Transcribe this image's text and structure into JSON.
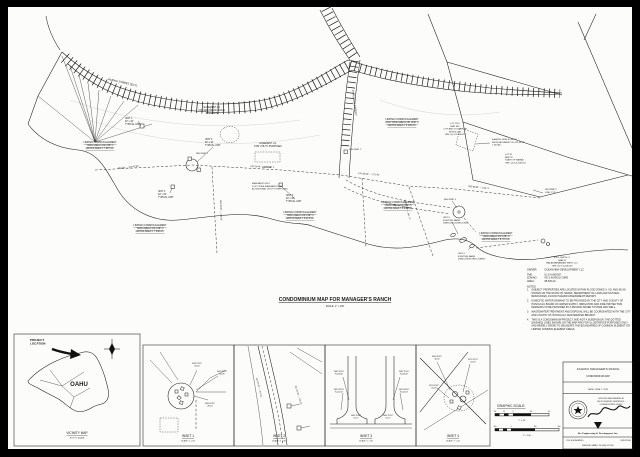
{
  "title": {
    "text": "CONDOMINIUM MAP FOR MANAGER'S RANCH",
    "scale": "SCALE: 1\" = 100'"
  },
  "notes": {
    "owner_label": "OWNER:",
    "owner": "OCEANVIEW DEVELOPMENT LLC",
    "info": [
      {
        "k": "TMK:",
        "v": "(1) 5-6-008:007"
      },
      {
        "k": "ZONING:",
        "v": "AG-2 AGRICULTURE"
      },
      {
        "k": "AREA:",
        "v": "98.636 AC."
      }
    ],
    "heading": "NOTES:",
    "items": [
      "SUBJECT PROPERTIES ARE LOCATED WITHIN FLOOD ZONES X, XS, AND AE AS SHOWN ON THE STATE OF HAWAII, DEPARTMENT OF LAND AND NATURAL RESOURCES, FLOOD HAZARD ASSESSMENT REPORT.",
      "DOMESTIC WATER DEMAND TO BE PROVIDED BY THE CITY AND COUNTY OF HONOLULU BOARD OF WATER SUPPLY. IRRIGATION AND FIRE PROTECTION DEMANDS TO BE PROVIDED BY A PRIVATE WATER SYSTEM AND WELL.",
      "WASTEWATER TREATMENT AND DISPOSAL WILL BE COORDINATED WITH THE CITY AND COUNTY OF HONOLULU WASTEWATER BRANCH.",
      "THIS IS A CONDOMINIUM PROJECT, AND NOT A SUBDIVISION. THE DOTTED (DASHED) LINES SHOWN ON THE MAP ARE FOR ILLUSTRATIVE PURPOSES ONLY AND MERELY SERVE TO DELINEATE THE BOUNDARIES OF COMMON ELEMENT OR LIMITED COMMON ELEMENT AREAS."
    ]
  },
  "map": {
    "labels": [
      {
        "x": 335,
        "y": 301,
        "t": "CONDOMINIUM MAP FOR MANAGER'S RANCH",
        "s": 5,
        "b": 1,
        "u": 1,
        "a": "middle",
        "n": "map-title"
      },
      {
        "x": 335,
        "y": 307,
        "t": "SCALE: 1\" = 100'",
        "s": 2.4,
        "a": "middle",
        "n": "map-scale"
      },
      {
        "x": 108,
        "y": 80,
        "rot": 13,
        "t": "HUEHU STREET (EXT)",
        "s": 2.8,
        "n": "street-label-huehu"
      },
      {
        "x": 352,
        "y": 90,
        "rot": 83,
        "t": "PUALALEA STREET",
        "s": 2.8,
        "n": "street-label-pualalea"
      },
      {
        "x": 212,
        "y": 108,
        "a": "middle",
        "t": "EASEMENT A-1\nFOR ARCHAEOLOGICAL\nPRESERVE",
        "s": 2.3,
        "n": "easement-a1-label"
      },
      {
        "x": 268,
        "y": 144,
        "a": "middle",
        "t": "EASEMENT U-1\nFOR UTILITY PURPOSES",
        "s": 2.3,
        "n": "easement-u1-label"
      },
      {
        "x": 252,
        "y": 184,
        "t": "EASEMENT DW-1\n16 FT. WIDE EASEMENT FOR\nACCESS AND UTILITY PURPOSES",
        "s": 2.2,
        "n": "easement-dw1-label"
      },
      {
        "x": 100,
        "y": 143,
        "a": "middle",
        "u": 1,
        "t": "LIMITED COMMON ELEMENT\nYARD AREA FOR UNIT 1\nGROSS AREA = 7.687 AC.",
        "s": 2.4,
        "n": "lce-unit1"
      },
      {
        "x": 150,
        "y": 226,
        "a": "middle",
        "u": 1,
        "t": "LIMITED COMMON ELEMENT\nYARD AREA FOR UNIT 2\nGROSS AREA = 7.946 AC.",
        "s": 2.4,
        "n": "lce-unit2"
      },
      {
        "x": 300,
        "y": 213,
        "a": "middle",
        "u": 1,
        "t": "LIMITED COMMON ELEMENT\nYARD AREA FOR UNIT 3\nGROSS AREA = 8.113 AC.",
        "s": 2.4,
        "n": "lce-unit3"
      },
      {
        "x": 402,
        "y": 120,
        "a": "middle",
        "u": 1,
        "t": "LIMITED COMMON ELEMENT\nAND YARD AREA FOR UNIT 4\nGROSS AREA = 5.228 AC.",
        "s": 2.4,
        "n": "lce-unit4"
      },
      {
        "x": 398,
        "y": 203,
        "a": "middle",
        "u": 1,
        "t": "LIMITED COMMON ELEMENT\nYARD AREA FOR UNIT 5\nGROSS AREA = 6.034 AC.",
        "s": 2.4,
        "n": "lce-unit5"
      },
      {
        "x": 496,
        "y": 234,
        "a": "middle",
        "u": 1,
        "t": "LIMITED COMMON ELEMENT\nYARD AREA FOR UNIT 6\nGROSS AREA = 8.767 AC.",
        "s": 2.4,
        "n": "lce-unit6"
      },
      {
        "x": 125,
        "y": 119,
        "t": "UNIT 1\n40' x 40'\nTYPICAL UNIT",
        "s": 2.3,
        "n": "unit1-callout"
      },
      {
        "x": 205,
        "y": 140,
        "t": "UNIT 2\n40' x 40'\nTYPICAL UNIT",
        "s": 2.3,
        "n": "unit2-callout"
      },
      {
        "x": 158,
        "y": 192,
        "t": "UNIT 3\n40' x 40'\nTYPICAL UNIT",
        "s": 2.3,
        "n": "unit3-callout"
      },
      {
        "x": 286,
        "y": 196,
        "t": "UNIT 4\n40' x 40'\nTYPICAL UNIT",
        "s": 2.3,
        "n": "unit4-callout"
      },
      {
        "x": 443,
        "y": 218,
        "t": "UNIT 5\nEXISTING FARM\nDWELLING (DWELLING)",
        "s": 2.2,
        "n": "unit5-callout"
      },
      {
        "x": 458,
        "y": 254,
        "t": "UNIT 6\nEXISTING FARM\nDWELLING/STRUCTURES",
        "s": 2.2,
        "n": "unit6-callout"
      },
      {
        "x": 455,
        "y": 124,
        "a": "middle",
        "t": "LOT 1110\nBMP 632\nCITY AND COUNTY OF\nHONOLULU\nTMK: (1) 5-6-008:020",
        "s": 2.2,
        "n": "lot-1110-label"
      },
      {
        "x": 492,
        "y": 140,
        "t": "KAHUKU HIGH SCHOOL\nENCROACHMENT 42,128.44 SF\n1.434 AC.",
        "s": 2.2,
        "n": "school-encroachment-label"
      },
      {
        "x": 505,
        "y": 155,
        "t": "LOT 47\nBMP 32\nSTATE OF HAWAII\nTMK: (1) 5-6-008:001",
        "s": 2.2,
        "n": "lot-47-label"
      },
      {
        "x": 562,
        "y": 258,
        "a": "middle",
        "t": "EXCLUSION #1\n(MAP 2)\nMALAEKAHANA AG WEST LLC\nTMK: (1) 5-6-008:033",
        "s": 2.2,
        "n": "exclusion-label"
      },
      {
        "x": 545,
        "y": 190,
        "t": "PROPERTY\nLINE, TYP.",
        "s": 2.2,
        "n": "property-line-label"
      },
      {
        "x": 118,
        "y": 169,
        "rot": -6,
        "t": "762.08' — S72°47'30\"",
        "s": 2.2,
        "n": "bearing-label"
      },
      {
        "x": 250,
        "y": 167,
        "rot": 2,
        "t": "S78°26'40\" — 970.49'",
        "s": 2.2,
        "n": "bearing-label"
      },
      {
        "x": 358,
        "y": 174,
        "rot": 4,
        "t": "S79°58'20\" — 271.46'",
        "s": 2.2,
        "n": "bearing-label"
      },
      {
        "x": 468,
        "y": 187,
        "rot": 6,
        "t": "S82°05'30\" — 246.71'",
        "s": 2.2,
        "n": "bearing-label"
      },
      {
        "x": 404,
        "y": 200,
        "rot": 75,
        "t": "N06°15'40\" — 307.73'",
        "s": 2.1,
        "n": "bearing-label"
      },
      {
        "x": 220,
        "y": 200,
        "rot": 88,
        "t": "N03°39'20\" — 165.08'",
        "s": 2.1,
        "n": "bearing-label"
      },
      {
        "x": 196,
        "y": 154,
        "t": "SEE INSET 1",
        "s": 2,
        "n": "see-inset-1"
      },
      {
        "x": 349,
        "y": 150,
        "t": "SEE INSET 2",
        "s": 2,
        "n": "see-inset-2"
      },
      {
        "x": 262,
        "y": 168,
        "t": "SEE INSET 3",
        "s": 2,
        "n": "see-inset-3"
      },
      {
        "x": 444,
        "y": 200,
        "t": "SEE INSET 4",
        "s": 2,
        "n": "see-inset-4"
      },
      {
        "x": 30,
        "y": 341,
        "t": "PROJECT\nLOCATION",
        "s": 3,
        "b": 1,
        "n": "project-location-label"
      },
      {
        "x": 79,
        "y": 386,
        "t": "OAHU",
        "s": 6,
        "b": 1,
        "a": "middle",
        "n": "island-label"
      },
      {
        "x": 77,
        "y": 434,
        "t": "VICINITY MAP",
        "s": 3.2,
        "u": 1,
        "a": "middle",
        "n": "vicinity-caption"
      },
      {
        "x": 77,
        "y": 438.6,
        "t": "NOT TO SCALE",
        "s": 2,
        "a": "middle",
        "n": "vicinity-subcaption"
      },
      {
        "x": 188,
        "y": 437,
        "t": "INSET 1",
        "s": 3.2,
        "u": 1,
        "a": "middle",
        "n": "inset-1-caption"
      },
      {
        "x": 188,
        "y": 441.6,
        "t": "SCALE: 1\" = 30'",
        "s": 1.9,
        "a": "middle",
        "n": "inset-1-scale"
      },
      {
        "x": 279,
        "y": 437,
        "t": "INSET 2",
        "s": 3.2,
        "u": 1,
        "a": "middle",
        "n": "inset-2-caption"
      },
      {
        "x": 279,
        "y": 441.6,
        "t": "SCALE: 1\" = 30'",
        "s": 1.9,
        "a": "middle",
        "n": "inset-2-scale"
      },
      {
        "x": 366,
        "y": 437,
        "t": "INSET 3",
        "s": 3.2,
        "u": 1,
        "a": "middle",
        "n": "inset-3-caption"
      },
      {
        "x": 366,
        "y": 441.6,
        "t": "SCALE: 1\" = 30'",
        "s": 1.9,
        "a": "middle",
        "n": "inset-3-scale"
      },
      {
        "x": 453,
        "y": 437,
        "t": "INSET 4",
        "s": 3.2,
        "u": 1,
        "a": "middle",
        "n": "inset-4-caption"
      },
      {
        "x": 453,
        "y": 441.6,
        "t": "SCALE: 1\" = 30'",
        "s": 1.9,
        "a": "middle",
        "n": "inset-4-scale"
      },
      {
        "x": 197,
        "y": 364,
        "a": "middle",
        "t": "S08°15'30\"\n30.00'",
        "s": 2,
        "n": "inset1-bearing"
      },
      {
        "x": 222,
        "y": 372,
        "a": "middle",
        "t": "N41°23'10\"\n56.08'",
        "s": 2,
        "n": "inset1-bearing"
      },
      {
        "x": 210,
        "y": 404,
        "a": "middle",
        "t": "N83°02'40\"\n28.00'",
        "s": 2,
        "n": "inset1-bearing"
      },
      {
        "x": 256,
        "y": 378,
        "rot": 76,
        "t": "N10°28'30\" — 262.40'",
        "s": 2,
        "n": "inset2-bearing"
      },
      {
        "x": 295,
        "y": 386,
        "rot": 73,
        "t": "N12°46'10\" — 154.22'",
        "s": 2,
        "n": "inset2-bearing"
      },
      {
        "x": 339,
        "y": 372,
        "a": "middle",
        "t": "N08°15'30\"\nR=28.00'",
        "s": 2,
        "n": "inset3-bearing"
      },
      {
        "x": 339,
        "y": 390,
        "a": "middle",
        "t": "N81°44'30\"\nR=20.00'",
        "s": 2,
        "n": "inset3-bearing"
      },
      {
        "x": 404,
        "y": 372,
        "a": "middle",
        "t": "N08°15'30\"\nR=28.00'",
        "s": 2,
        "n": "inset3-bearing"
      },
      {
        "x": 404,
        "y": 390,
        "a": "middle",
        "t": "N81°44'30\"\nR=20.00'",
        "s": 2,
        "n": "inset3-bearing"
      },
      {
        "x": 356,
        "y": 416,
        "a": "middle",
        "t": "N08°15'30\"\n16.17'",
        "s": 2,
        "n": "inset3-bearing"
      },
      {
        "x": 388,
        "y": 416,
        "a": "middle",
        "t": "N08°15'30\"\n16.17'",
        "s": 2,
        "n": "inset3-bearing"
      },
      {
        "x": 437,
        "y": 357,
        "a": "middle",
        "t": "S68°30'50\"\n30.00'",
        "s": 2,
        "n": "inset4-bearing"
      },
      {
        "x": 473,
        "y": 360,
        "a": "middle",
        "t": "N21°29'10\"\n24.00'",
        "s": 2,
        "n": "inset4-bearing"
      },
      {
        "x": 434,
        "y": 386,
        "a": "middle",
        "t": "S81°02'40\"\n18.00'",
        "s": 2,
        "n": "inset4-bearing"
      },
      {
        "x": 497,
        "y": 407,
        "t": "GRAPHIC SCALE:",
        "s": 3.4,
        "u": 1,
        "n": "graphic-scale-heading"
      },
      {
        "x": 495,
        "y": 412,
        "a": "middle",
        "t": "30",
        "s": 1.7,
        "n": "scalebar-tick"
      },
      {
        "x": 504,
        "y": 412,
        "a": "middle",
        "t": "15",
        "s": 1.7,
        "n": "scalebar-tick"
      },
      {
        "x": 513,
        "y": 412,
        "a": "middle",
        "t": "0",
        "s": 1.7,
        "n": "scalebar-tick"
      },
      {
        "x": 531,
        "y": 412,
        "a": "middle",
        "t": "30",
        "s": 1.7,
        "n": "scalebar-tick"
      },
      {
        "x": 549,
        "y": 412,
        "a": "middle",
        "t": "60",
        "s": 1.7,
        "n": "scalebar-tick"
      },
      {
        "x": 522,
        "y": 421,
        "a": "middle",
        "t": "1\" = 30'",
        "s": 2.2,
        "n": "scalebar-caption"
      },
      {
        "x": 495,
        "y": 427,
        "a": "middle",
        "t": "100",
        "s": 1.7,
        "n": "scalebar-tick"
      },
      {
        "x": 511,
        "y": 427,
        "a": "middle",
        "t": "0",
        "s": 1.7,
        "n": "scalebar-tick"
      },
      {
        "x": 535,
        "y": 427,
        "a": "middle",
        "t": "100",
        "s": 1.7,
        "n": "scalebar-tick"
      },
      {
        "x": 559,
        "y": 427,
        "a": "middle",
        "t": "200",
        "s": 1.7,
        "n": "scalebar-tick"
      },
      {
        "x": 527,
        "y": 436,
        "a": "middle",
        "t": "1\" = 100'",
        "s": 2.2,
        "n": "scalebar-caption"
      },
      {
        "x": 598,
        "y": 370,
        "a": "middle",
        "t": "KAHUKU MANAGER'S RANCH",
        "s": 3,
        "n": "titleblock-project"
      },
      {
        "x": 598,
        "y": 377,
        "a": "middle",
        "t": "CONDOMINIUM MAP",
        "s": 2.4,
        "n": "titleblock-subtitle"
      },
      {
        "x": 598,
        "y": 390,
        "a": "middle",
        "t": "DATE: JUNE 7, 2021",
        "s": 2.2,
        "n": "titleblock-date"
      },
      {
        "x": 611,
        "y": 399,
        "a": "middle",
        "t": "THIS WORK WAS PREPARED BY",
        "s": 1.7,
        "n": "stamp-text"
      },
      {
        "x": 611,
        "y": 402,
        "a": "middle",
        "t": "ME OR UNDER MY SUPERVISION.",
        "s": 1.7,
        "n": "stamp-text"
      },
      {
        "x": 611,
        "y": 405,
        "a": "middle",
        "t": "LICENSE EXPIRES: 04/30/22",
        "s": 1.7,
        "n": "stamp-text"
      },
      {
        "x": 598,
        "y": 434,
        "a": "middle",
        "b": 1,
        "f": "serif",
        "t": "Bee Engineering & Development, Inc.",
        "s": 2.5,
        "n": "firm-name"
      },
      {
        "x": 566,
        "y": 441,
        "t": "CIVIL ENGINEERING",
        "s": 1.8,
        "n": "firm-service-left"
      },
      {
        "x": 631,
        "y": 441,
        "a": "end",
        "t": "SURVEYING",
        "s": 1.8,
        "n": "firm-service-right"
      },
      {
        "x": 598,
        "y": 446,
        "a": "middle",
        "t": "KANEOHE, HAWAII • PH: (808) 247-2005",
        "s": 1.7,
        "n": "firm-address"
      }
    ]
  }
}
